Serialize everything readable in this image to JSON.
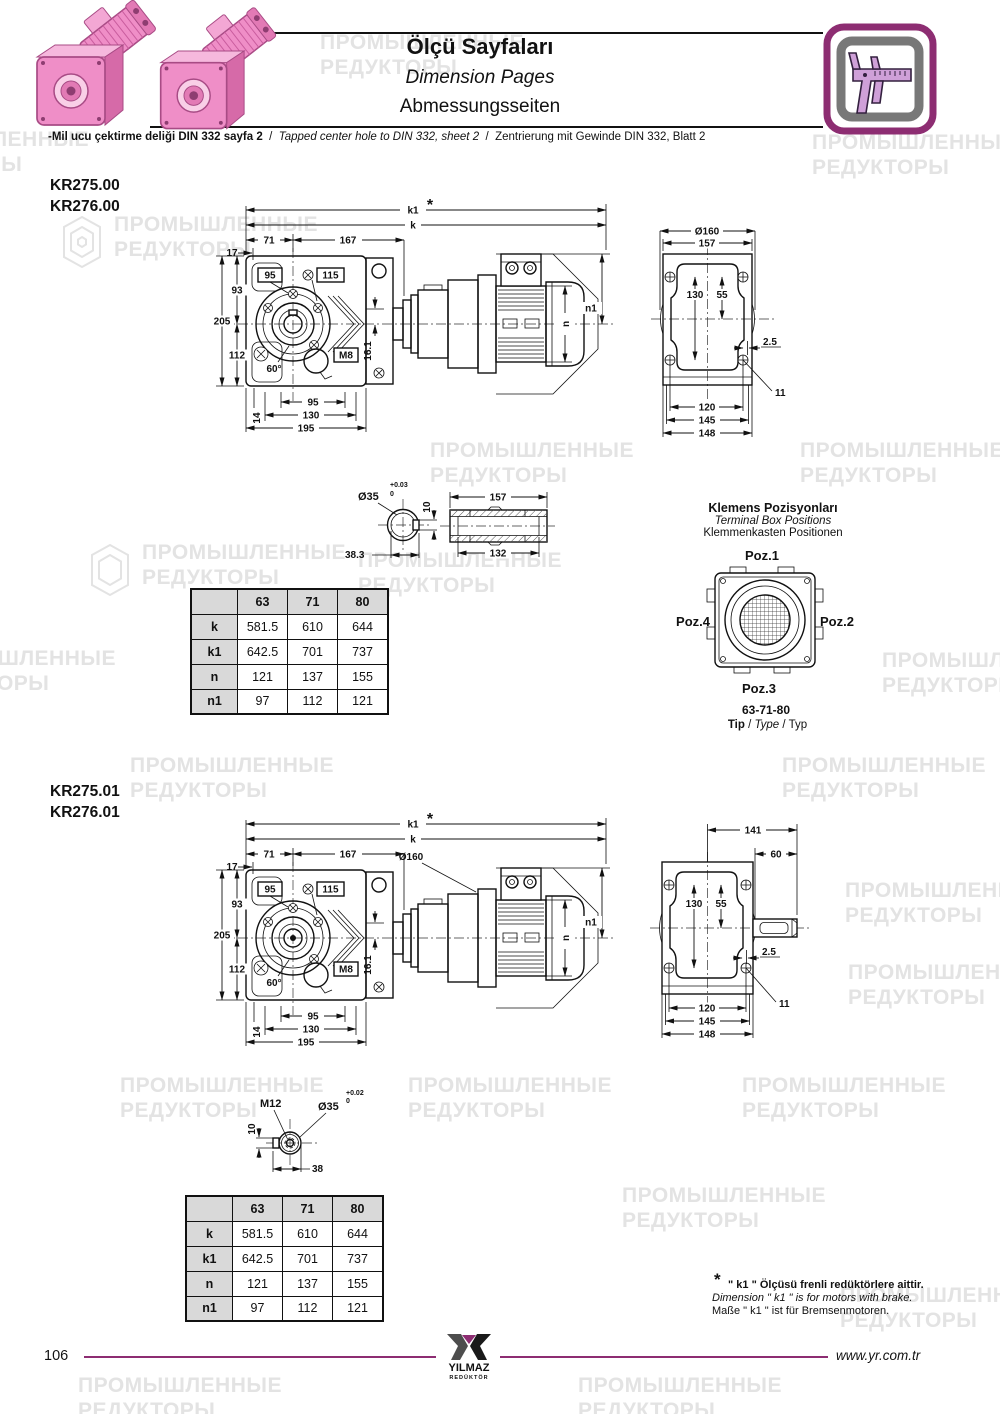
{
  "header": {
    "title_tr": "Ölçü Sayfaları",
    "title_en": "Dimension Pages",
    "title_de": "Abmessungsseiten",
    "note_tr": "-Mil ucu çektirme deliği DIN 332 sayfa 2",
    "sep": "/",
    "note_en": "Tapped center hole to DIN 332, sheet 2",
    "note_de": "Zentrierung mit Gewinde DIN 332, Blatt 2",
    "accent_color": "#8d2d72"
  },
  "watermark": {
    "line1": "ПРОМЫШЛЕННЫЕ",
    "line2": "РЕДУКТОРЫ",
    "color": "#e3e3e3"
  },
  "s1": {
    "model1": "KR275.00",
    "model2": "KR276.00",
    "front": {
      "k1": "k1",
      "star": "*",
      "k": "k",
      "d71": "71",
      "d167": "167",
      "d17": "17",
      "b95": "95",
      "b115": "115",
      "d93": "93",
      "d205": "205",
      "d112": "112",
      "d60": "60°",
      "m8": "M8",
      "d161": "16.1",
      "d14": "14",
      "p95": "95",
      "p130": "130",
      "p195": "195",
      "n": "n",
      "n1": "n1"
    },
    "rear": {
      "d160": "Ø160",
      "d157": "157",
      "d130": "130",
      "d55": "55",
      "d25": "2.5",
      "d11": "11",
      "d120": "120",
      "d145": "145",
      "d148": "148"
    },
    "shaft": {
      "dia": "Ø35",
      "tu": "+0.03",
      "td": "0",
      "d10": "10",
      "d383": "38.3",
      "d157": "157",
      "d132": "132"
    },
    "table": {
      "headers": [
        "",
        "63",
        "71",
        "80"
      ],
      "rows": [
        [
          "k",
          "581.5",
          "610",
          "644"
        ],
        [
          "k1",
          "642.5",
          "701",
          "737"
        ],
        [
          "n",
          "121",
          "137",
          "155"
        ],
        [
          "n1",
          "97",
          "112",
          "121"
        ]
      ]
    }
  },
  "terminal": {
    "title_tr": "Klemens Pozisyonları",
    "title_en": "Terminal Box Positions",
    "title_de": "Klemmenkasten Positionen",
    "poz1": "Poz.1",
    "poz2": "Poz.2",
    "poz3": "Poz.3",
    "poz4": "Poz.4",
    "types": "63-71-80",
    "tip_tr": "Tip",
    "tip_en": "Type",
    "tip_de": "Typ",
    "sep": "/"
  },
  "s2": {
    "model1": "KR275.01",
    "model2": "KR276.01",
    "front": {
      "k1": "k1",
      "star": "*",
      "k": "k",
      "d71": "71",
      "d167": "167",
      "d17": "17",
      "b95": "95",
      "b115": "115",
      "d93": "93",
      "d205": "205",
      "d112": "112",
      "d60": "60°",
      "m8": "M8",
      "d161": "16.1",
      "d14": "14",
      "p95": "95",
      "p130": "130",
      "p195": "195",
      "n": "n",
      "n1": "n1",
      "d160": "Ø160"
    },
    "rear": {
      "d141": "141",
      "d60": "60",
      "d130": "130",
      "d55": "55",
      "d25": "2.5",
      "d11": "11",
      "d120": "120",
      "d145": "145",
      "d148": "148"
    },
    "shaft": {
      "m12": "M12",
      "dia": "Ø35",
      "tu": "+0.02",
      "td": "0",
      "d10": "10",
      "d38": "38"
    },
    "table": {
      "headers": [
        "",
        "63",
        "71",
        "80"
      ],
      "rows": [
        [
          "k",
          "581.5",
          "610",
          "644"
        ],
        [
          "k1",
          "642.5",
          "701",
          "737"
        ],
        [
          "n",
          "121",
          "137",
          "155"
        ],
        [
          "n1",
          "97",
          "112",
          "121"
        ]
      ]
    }
  },
  "footnote": {
    "star": "*",
    "tr": "\" k1 \" Ölçüsü frenli redüktörlere aittir.",
    "en": "Dimension \" k1 \" is for motors with brake.",
    "de": "Maße \" k1 \" ist für Bremsenmotoren."
  },
  "footer": {
    "page": "106",
    "brand": "YILMAZ",
    "brand2": "REDÜKTÖR",
    "url": "www.yr.com.tr"
  }
}
